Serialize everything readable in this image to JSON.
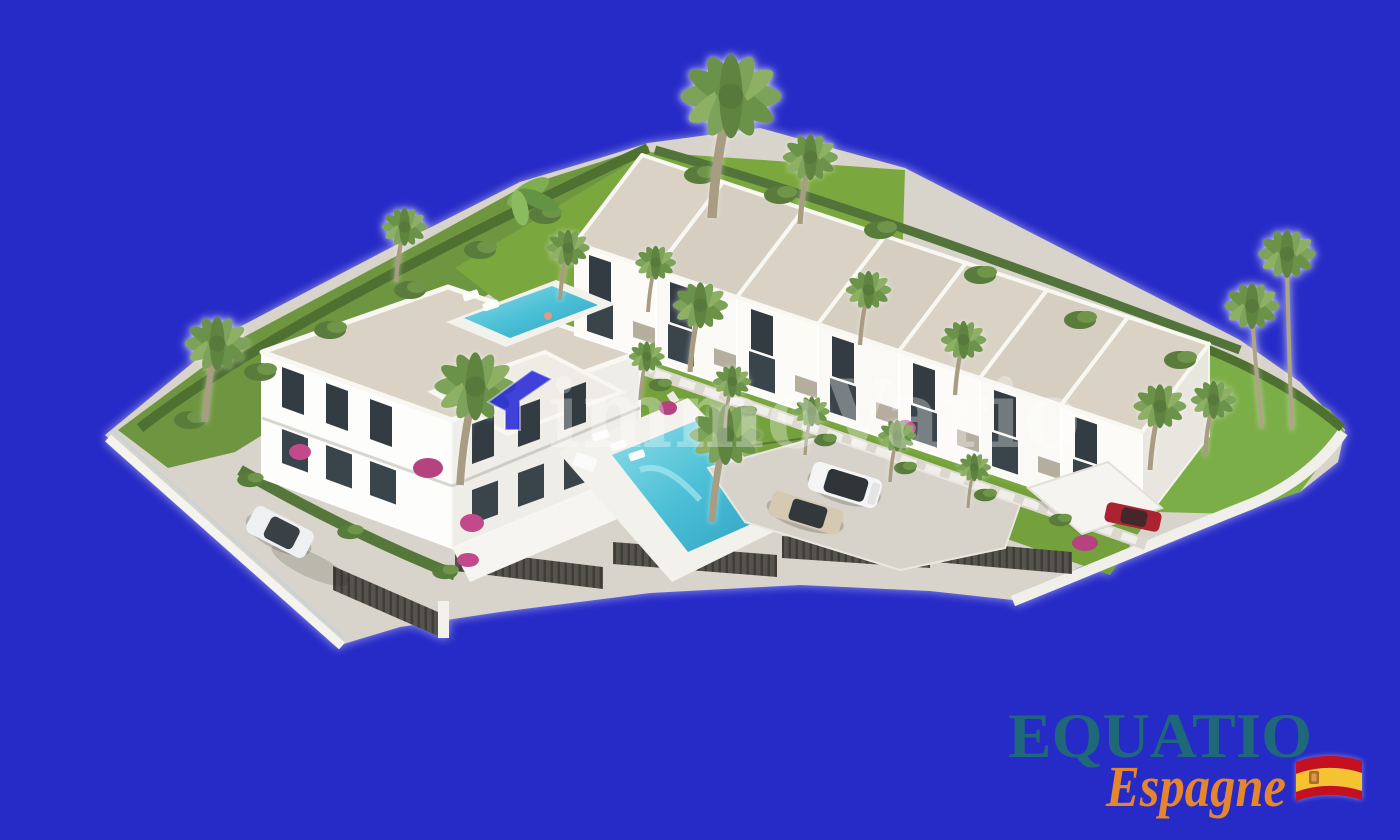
{
  "watermark": {
    "text": "immoVario",
    "text_color": "#ffffff",
    "arrow_icon": "arrow-logo-icon",
    "arrow_color": "#2d2fd8"
  },
  "agency_logo": {
    "name": "EQUATIO",
    "name_color": "#1f6879",
    "subtitle": "Espagne",
    "subtitle_color": "#e5862f",
    "flag_icon": "spain-flag-icon",
    "flag_red": "#c51022",
    "flag_yellow": "#f5c332"
  },
  "scene_colors": {
    "background": "#262ac7",
    "pavement": "#d8d4cb",
    "roof_gravel": "#d9d2c5",
    "building_white": "#fbfaf7",
    "window_dark": "#323c42",
    "lawn": "#79a63e",
    "hedge": "#50733a",
    "pool_water": "#4cc0d6",
    "fence_dark": "#55534c"
  }
}
